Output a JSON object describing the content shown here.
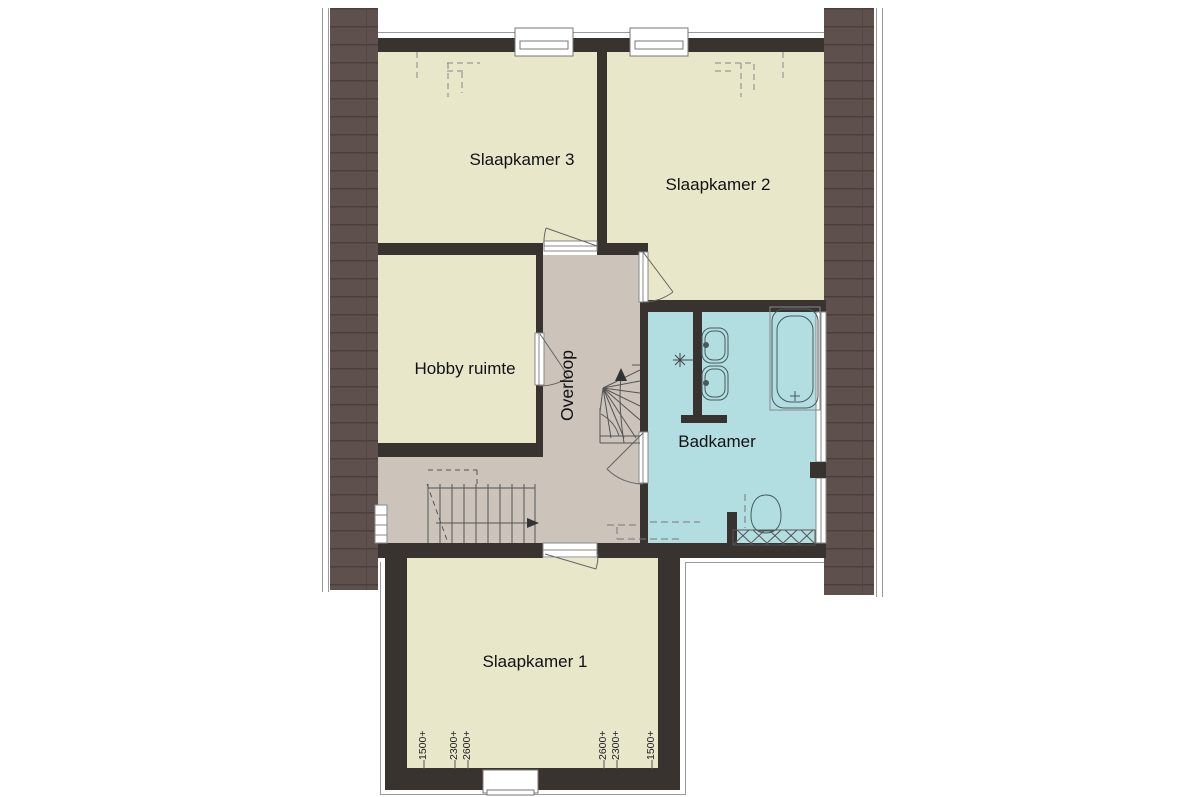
{
  "plan_type": "floor-plan",
  "rooms": {
    "slaapkamer3": "Slaapkamer 3",
    "slaapkamer2": "Slaapkamer 2",
    "hobby_ruimte": "Hobby ruimte",
    "overloop": "Overloop",
    "badkamer": "Badkamer",
    "slaapkamer1": "Slaapkamer 1"
  },
  "height_marks": {
    "left": [
      "1500+",
      "2300+",
      "2600+"
    ],
    "right": [
      "2600+",
      "2300+",
      "1500+"
    ]
  },
  "fixtures": {
    "bathtub": "bathtub",
    "washbasins": "double-washbasin",
    "toilet": "toilet",
    "light_point": "light-point",
    "straight_stair": "straight-staircase",
    "winding_stair": "winding-staircase"
  },
  "colors": {
    "background": "#ffffff",
    "room_fill": "#e9e7ca",
    "landing_fill": "#ccc3ba",
    "bathroom_fill": "#b2dee2",
    "roof_fill": "#5d504d",
    "roof_line": "#49403d",
    "wall": "#38332f"
  }
}
